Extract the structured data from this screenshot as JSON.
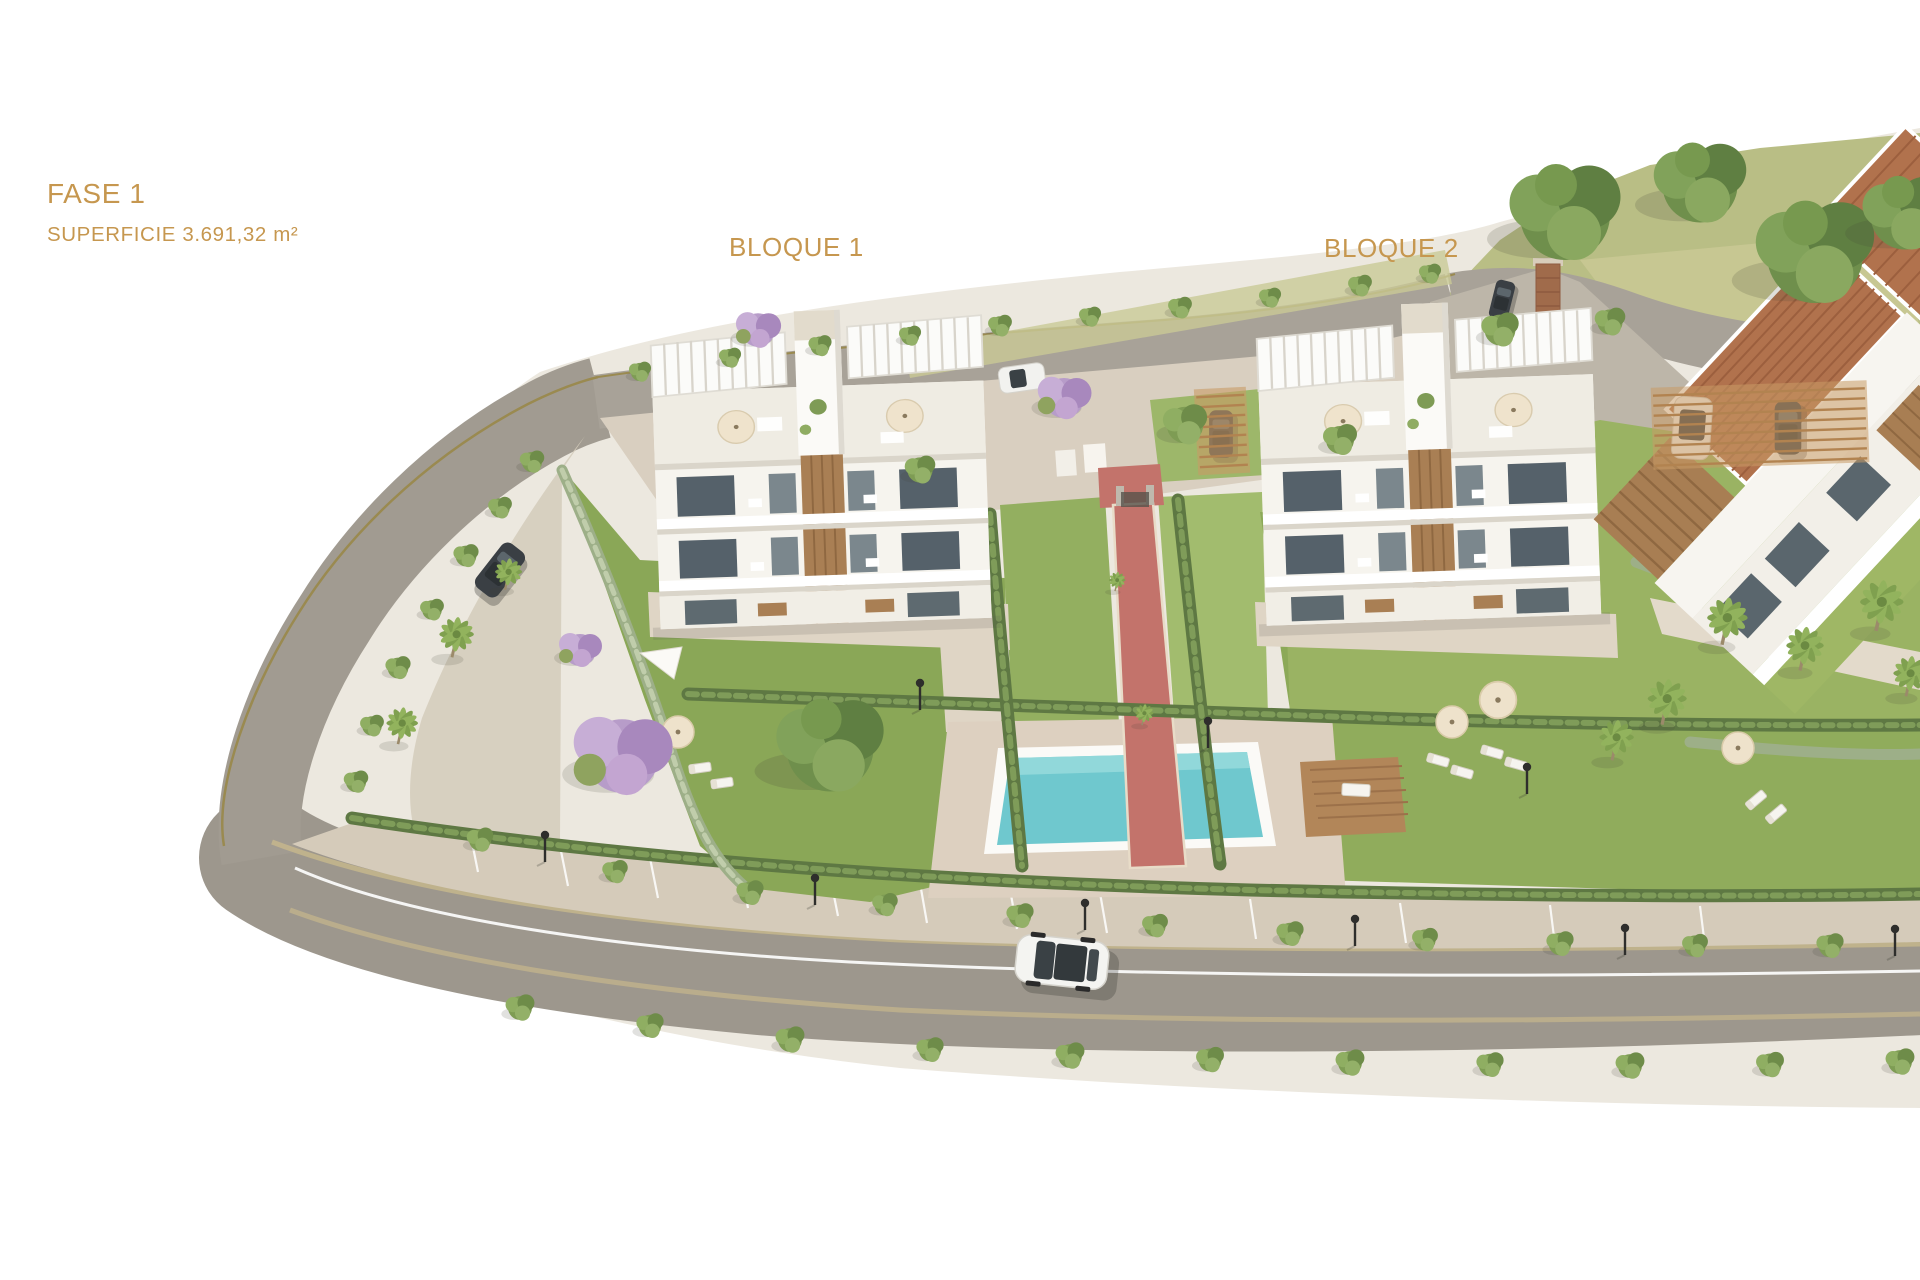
{
  "labels": {
    "phase": "FASE 1",
    "surface": "SUPERFICIE 3.691,32 m²",
    "block_1": "BLOQUE 1",
    "block_2": "BLOQUE 2"
  },
  "palette": {
    "label_gold": "#C6974F",
    "background_white": "#FFFFFF",
    "sidewalk_cream": "#ECE8DF",
    "road_gray": "#9D978D",
    "pavement_beige": "#DCD2C2",
    "lawn_green": "#8AA757",
    "hedge_green": "#5E7843",
    "pool_turquoise": "#6FC8CE",
    "path_red": "#C3736B",
    "wood_brown": "#A97F54",
    "roof_terracotta": "#B1724D",
    "jacaranda_purple": "#B79CC9"
  }
}
